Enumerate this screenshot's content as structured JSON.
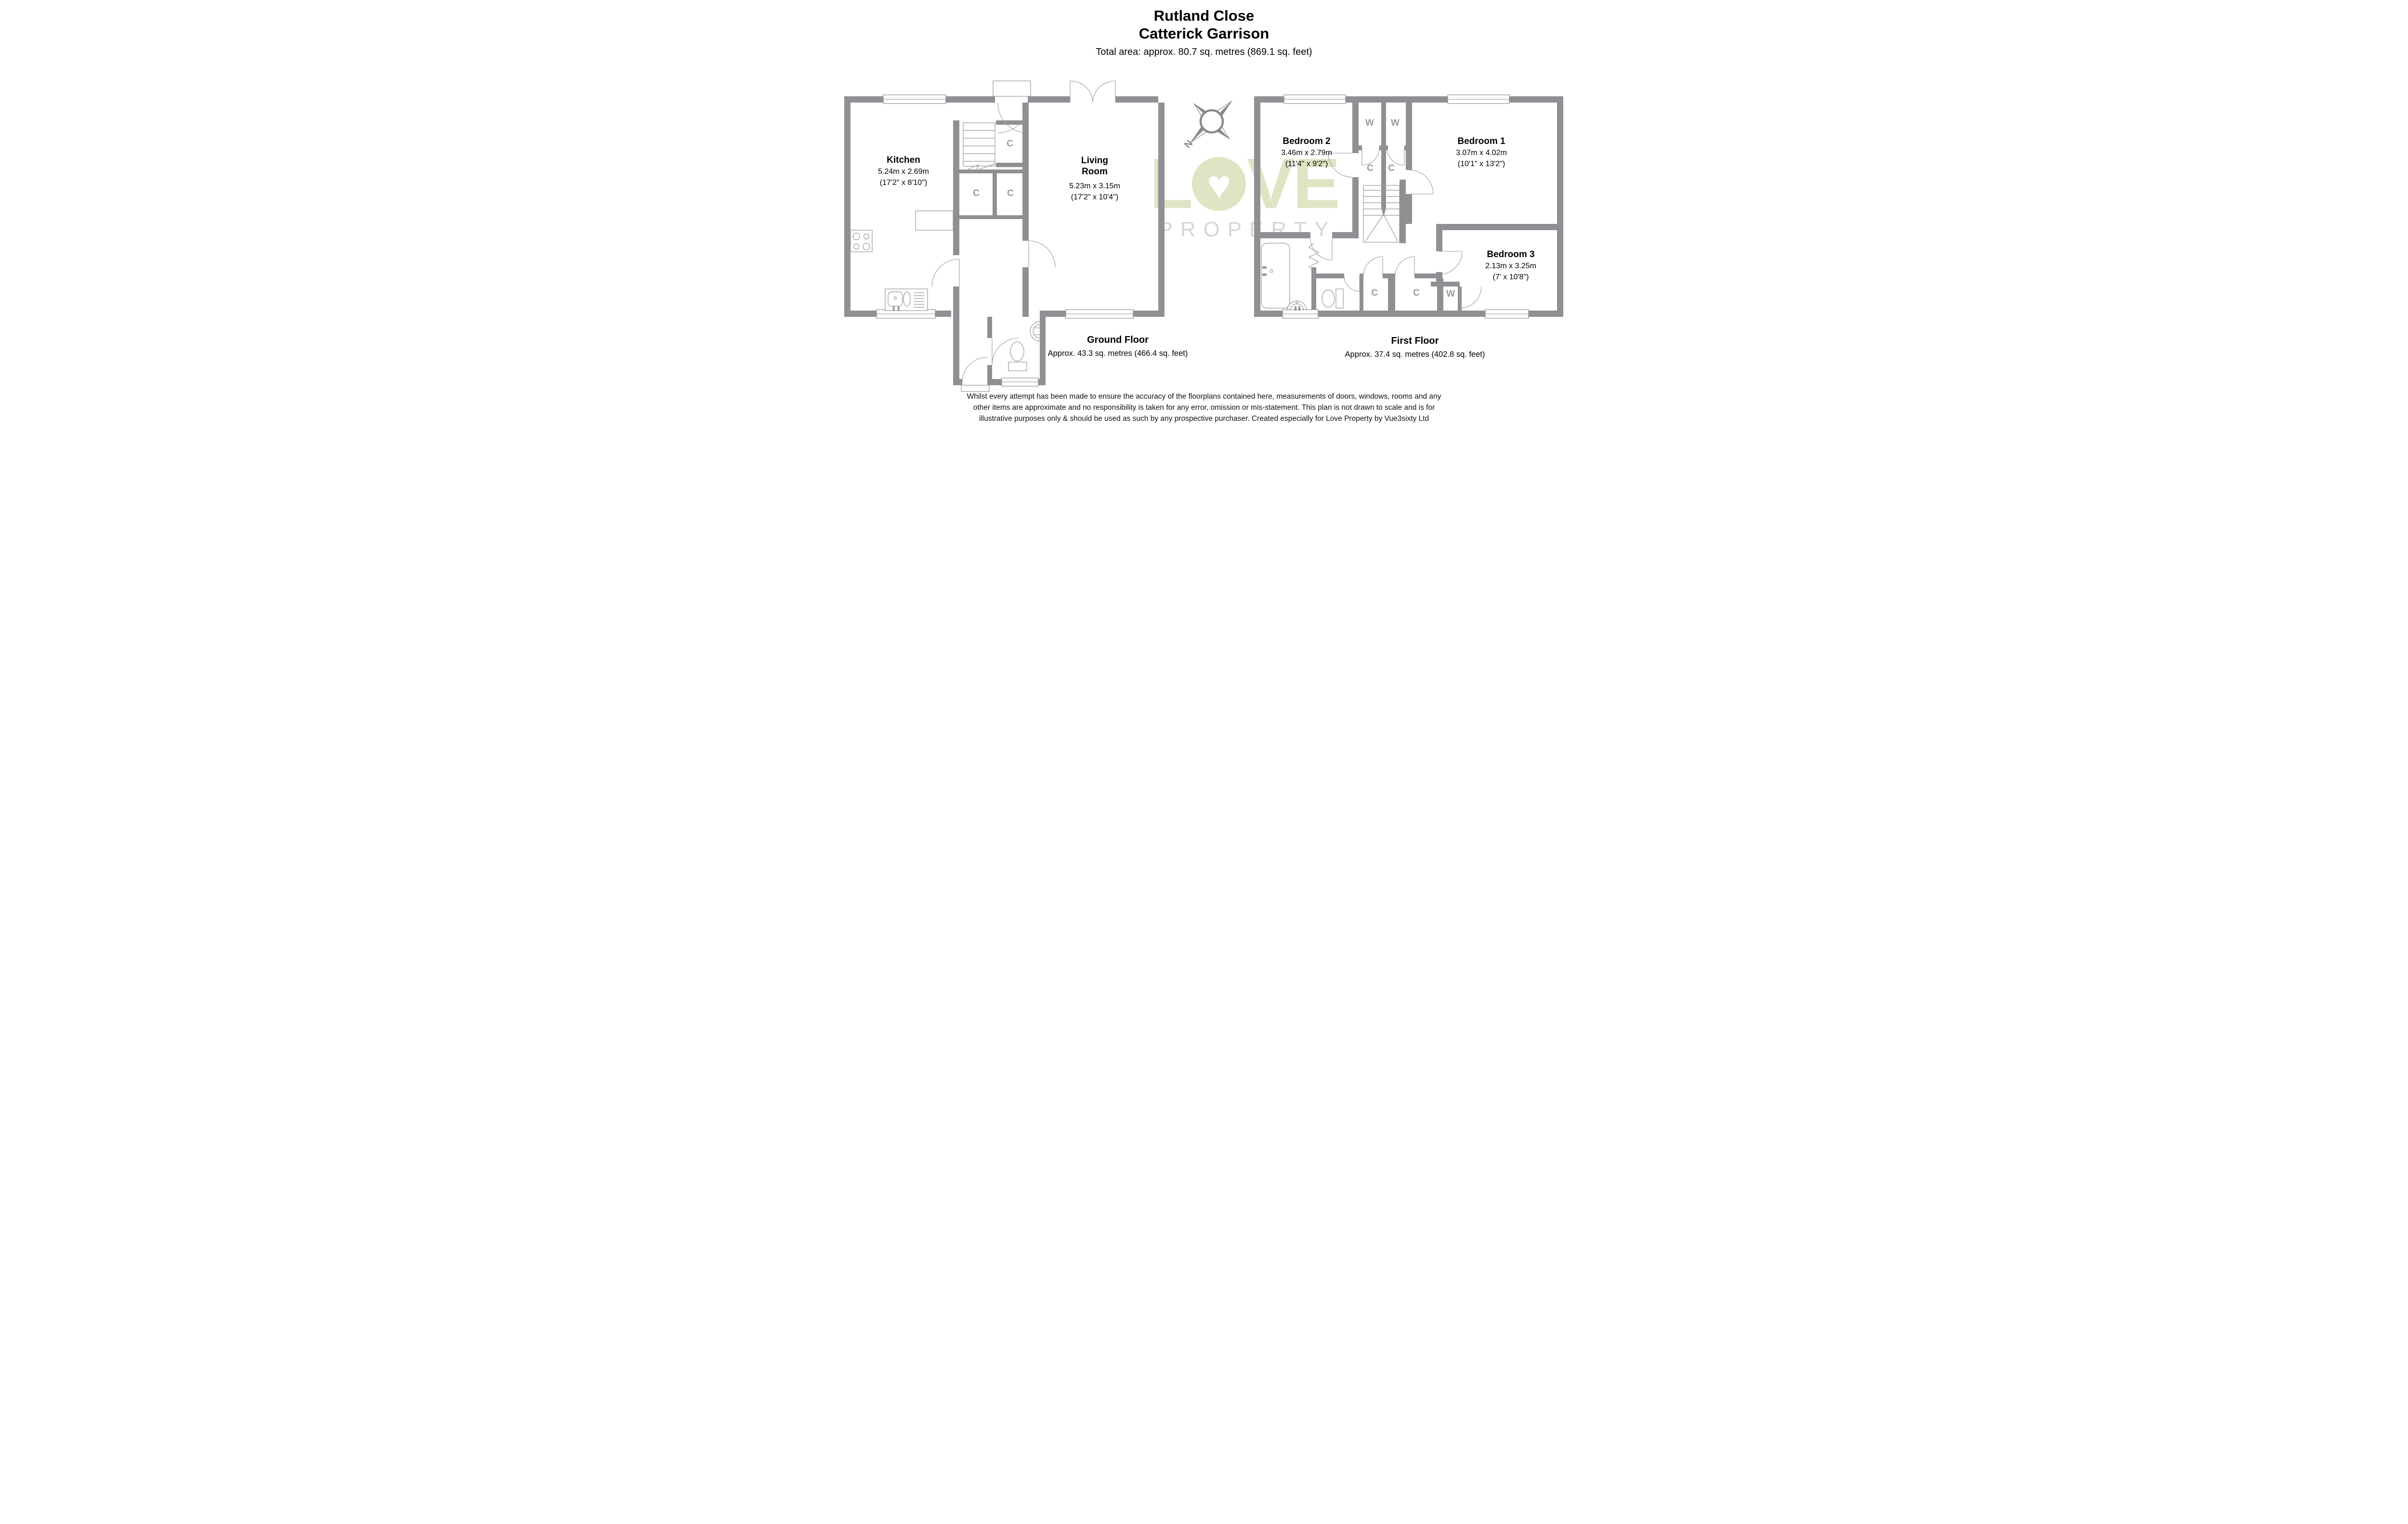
{
  "header": {
    "title_line1": "Rutland Close",
    "title_line2": "Catterick Garrison",
    "total_area": "Total area: approx. 80.7 sq. metres (869.1 sq. feet)"
  },
  "colors": {
    "wall_gray": "#8F9093",
    "closet_label_gray": "#9A9A9E",
    "watermark_green": "#DCE4C1",
    "watermark_gray": "#D4D4D4"
  },
  "compass": {
    "north_label": "N"
  },
  "watermark": {
    "line1_prefix": "L",
    "heart": "♥",
    "line1_suffix": "VE",
    "line2": "PROPERTY"
  },
  "ground_floor": {
    "rooms": {
      "kitchen": {
        "name": "Kitchen",
        "dims_metric": "5.24m x 2.69m",
        "dims_imperial": "(17'2\" x 8'10\")"
      },
      "living": {
        "name_line1": "Living",
        "name_line2": "Room",
        "dims_metric": "5.23m x 3.15m",
        "dims_imperial": "(17'2\" x 10'4\")"
      }
    },
    "closets": [
      {
        "label": "C"
      },
      {
        "label": "C"
      },
      {
        "label": "C"
      }
    ],
    "floor_label": "Ground Floor",
    "floor_area": "Approx. 43.3 sq. metres (466.4 sq. feet)"
  },
  "first_floor": {
    "rooms": {
      "bedroom2": {
        "name": "Bedroom 2",
        "dims_metric": "3.46m x 2.79m",
        "dims_imperial": "(11'4\" x 9'2\")"
      },
      "bedroom1": {
        "name": "Bedroom 1",
        "dims_metric": "3.07m x 4.02m",
        "dims_imperial": "(10'1\" x 13'2\")"
      },
      "bedroom3": {
        "name": "Bedroom 3",
        "dims_metric": "2.13m x 3.25m",
        "dims_imperial": "(7' x 10'8\")"
      }
    },
    "wardrobes": [
      {
        "label": "W"
      },
      {
        "label": "W"
      },
      {
        "label": "W"
      }
    ],
    "closets": [
      {
        "label": "C"
      },
      {
        "label": "C"
      },
      {
        "label": "C"
      },
      {
        "label": "C"
      }
    ],
    "floor_label": "First Floor",
    "floor_area": "Approx. 37.4 sq. metres (402.8 sq. feet)"
  },
  "disclaimer": {
    "line1": "Whilst every attempt has been made to ensure the accuracy of the floorplans contained here, measurements of doors, windows, rooms and any",
    "line2": "other items are approximate and no responsibility is taken for any error, omission or mis-statement. This plan is not drawn to scale and is for",
    "line3": "illustrative purposes only & should be used as such by any prospective purchaser. Created especially for Love Property by Vue3sixty Ltd"
  }
}
